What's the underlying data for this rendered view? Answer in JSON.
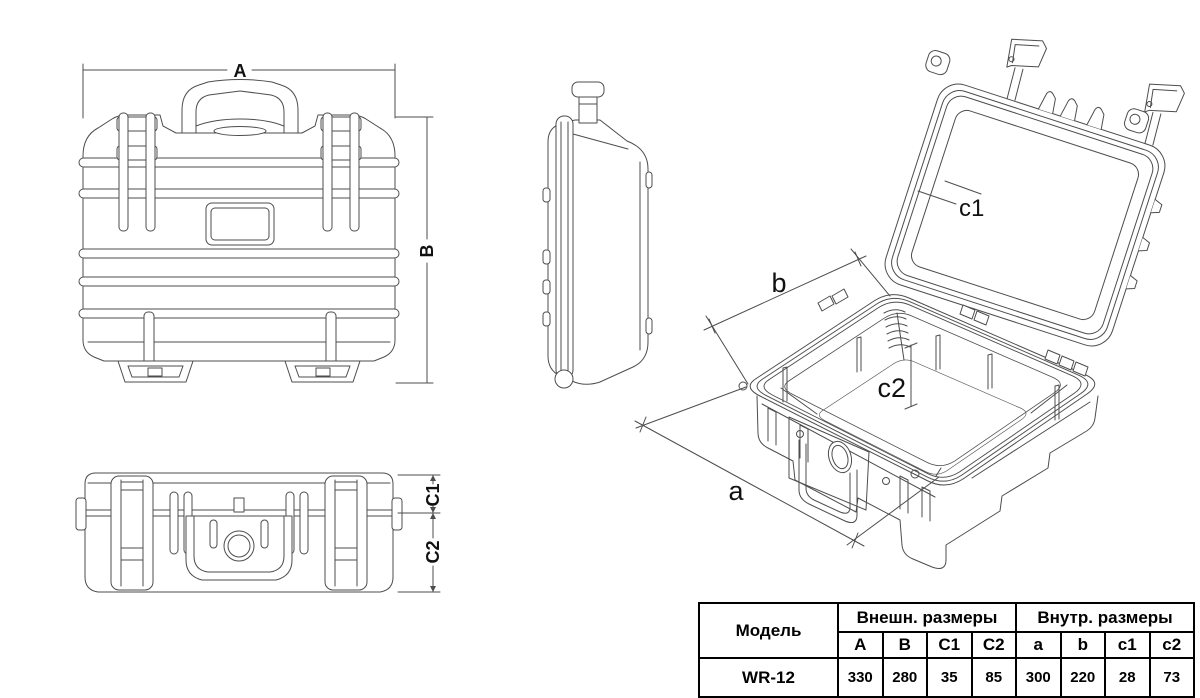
{
  "drawing": {
    "front_view": {
      "dim_width": "A",
      "dim_height": "B"
    },
    "top_view": {
      "dim_lid": "C1",
      "dim_base": "C2"
    },
    "perspective_view": {
      "dim_inner_width": "a",
      "dim_inner_depth": "b",
      "dim_lid_depth": "c1",
      "dim_base_depth": "c2"
    }
  },
  "table": {
    "model_header": "Модель",
    "group_headers": {
      "outer": "Внешн. размеры",
      "inner": "Внутр. размеры"
    },
    "columns": [
      "A",
      "B",
      "C1",
      "C2",
      "a",
      "b",
      "c1",
      "c2"
    ],
    "rows": [
      {
        "model": "WR-12",
        "values": [
          "330",
          "280",
          "35",
          "85",
          "300",
          "220",
          "28",
          "73"
        ]
      }
    ]
  },
  "colors": {
    "line": "#4d4d4d",
    "text": "#111111",
    "table_border": "#000000",
    "background": "#ffffff"
  }
}
